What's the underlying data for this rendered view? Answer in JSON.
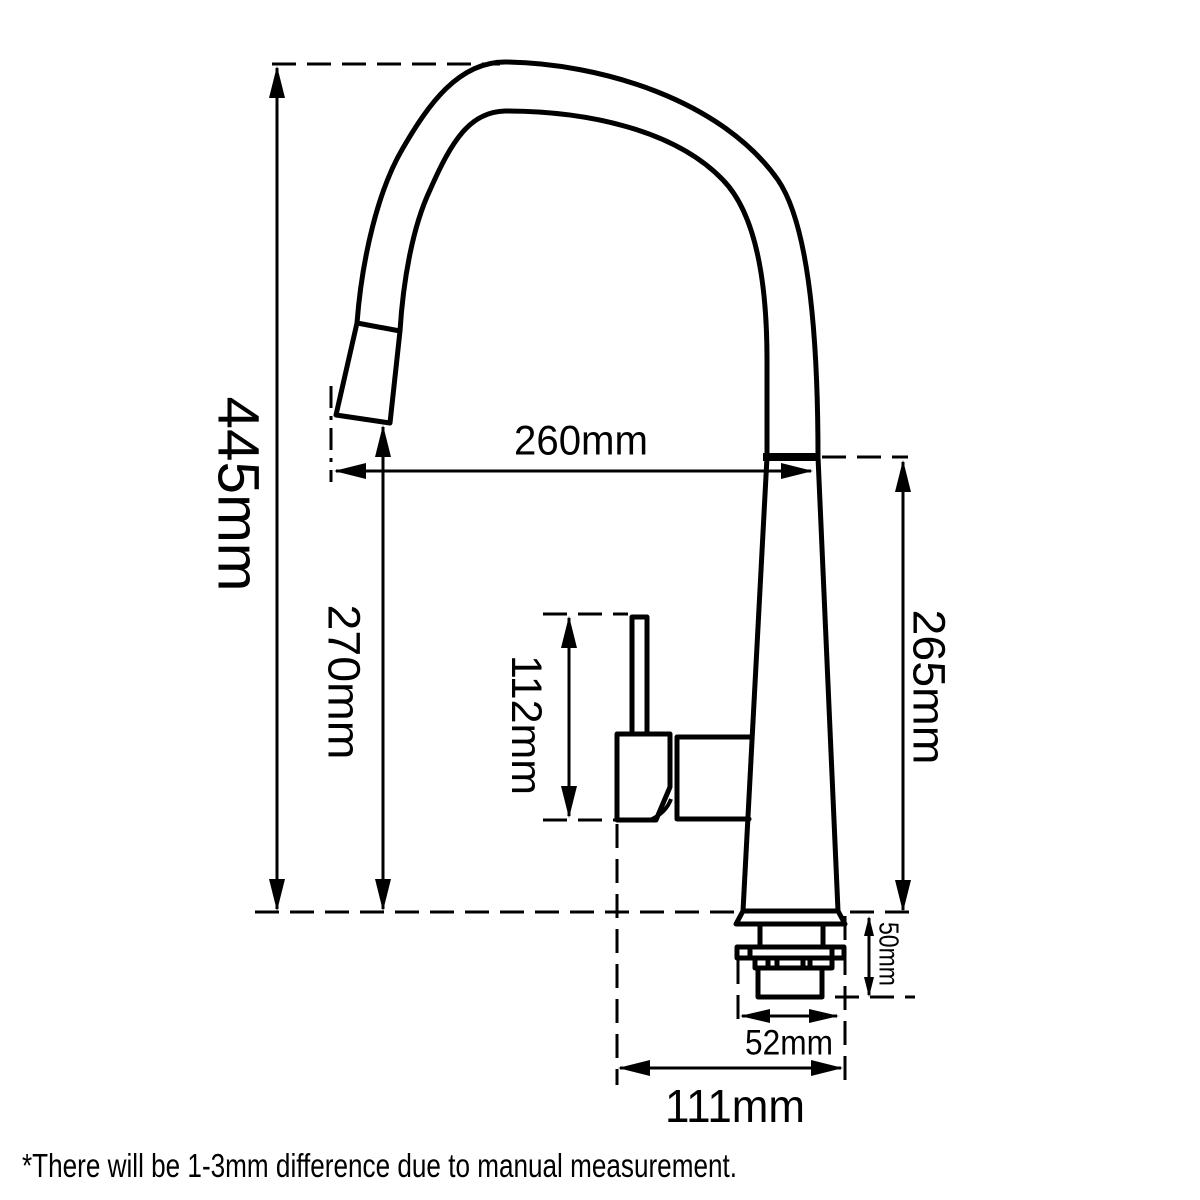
{
  "drawing": {
    "labels": {
      "overall_height": "445mm",
      "spout_reach": "260mm",
      "spout_outlet_height": "270mm",
      "handle_height": "112mm",
      "body_height": "265mm",
      "deck_thickness": "50mm",
      "base_diameter": "52mm",
      "base_footprint": "111mm"
    },
    "footnote": "*There will be 1-3mm difference due to manual measurement.",
    "colors": {
      "line": "#000000",
      "background": "#ffffff"
    }
  }
}
